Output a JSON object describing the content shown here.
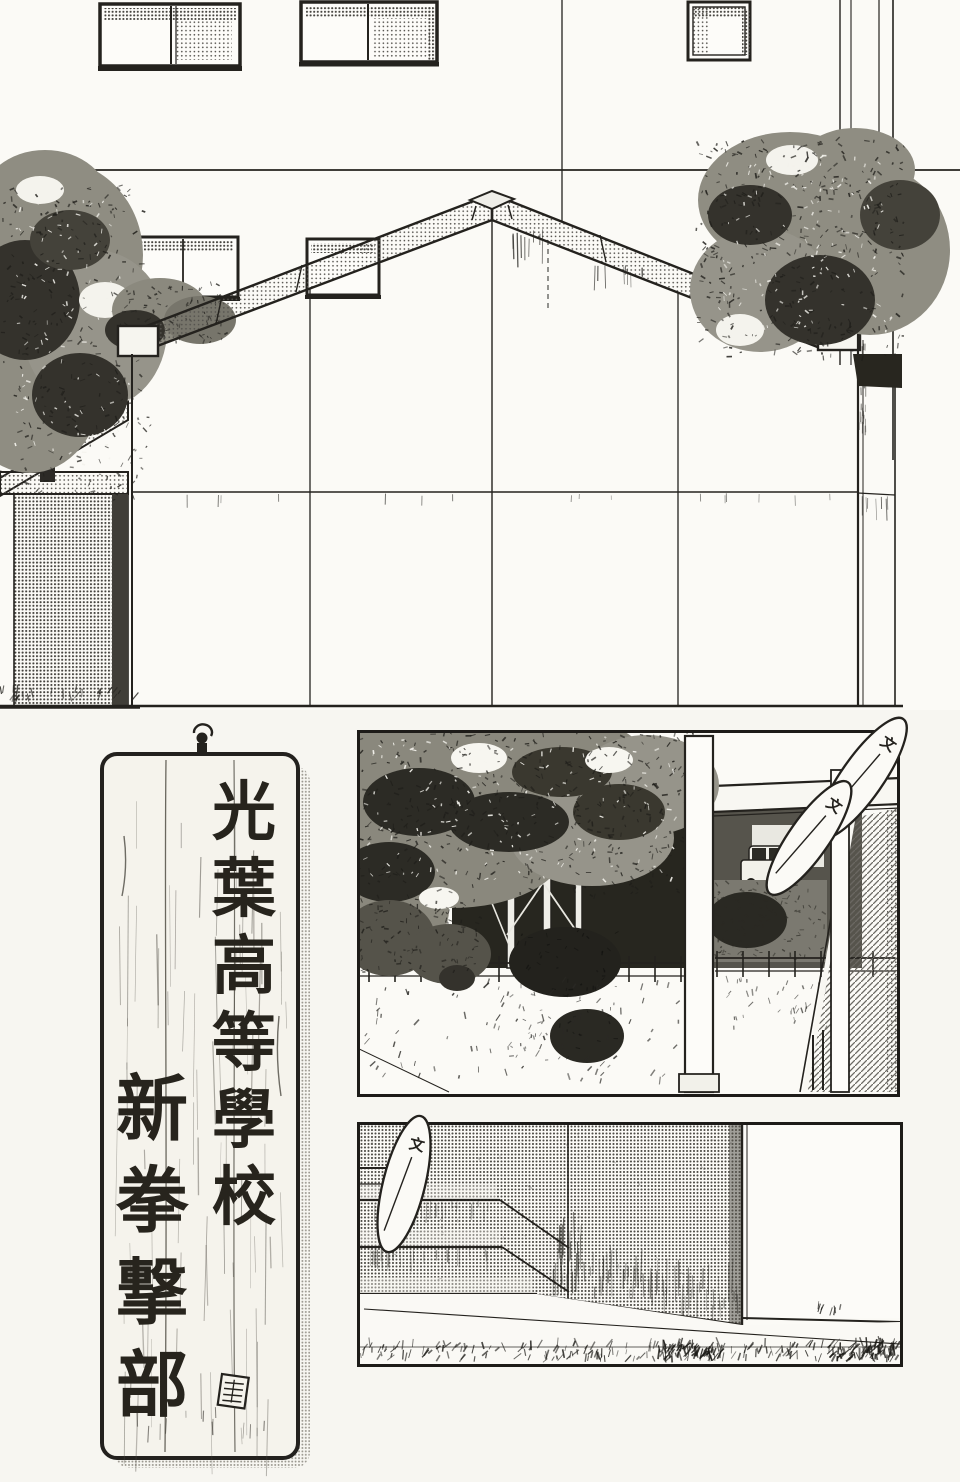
{
  "page": {
    "paper_color": "#f7f6f1",
    "ink_color": "#24221e",
    "halftone_color": "#8a8880",
    "panel_count": 4
  },
  "signboard": {
    "text_right_column": "光葉高等學校",
    "text_left_column": "新拳撃部",
    "chars_right": [
      "光",
      "葉",
      "高",
      "等",
      "學",
      "校"
    ],
    "chars_left": [
      "新",
      "拳",
      "撃",
      "部"
    ],
    "nail_icon": "nail-hook-icon",
    "seal_icon": "seal-stamp-icon"
  },
  "sfx": {
    "glyph": "文",
    "bubble_count": 3
  }
}
